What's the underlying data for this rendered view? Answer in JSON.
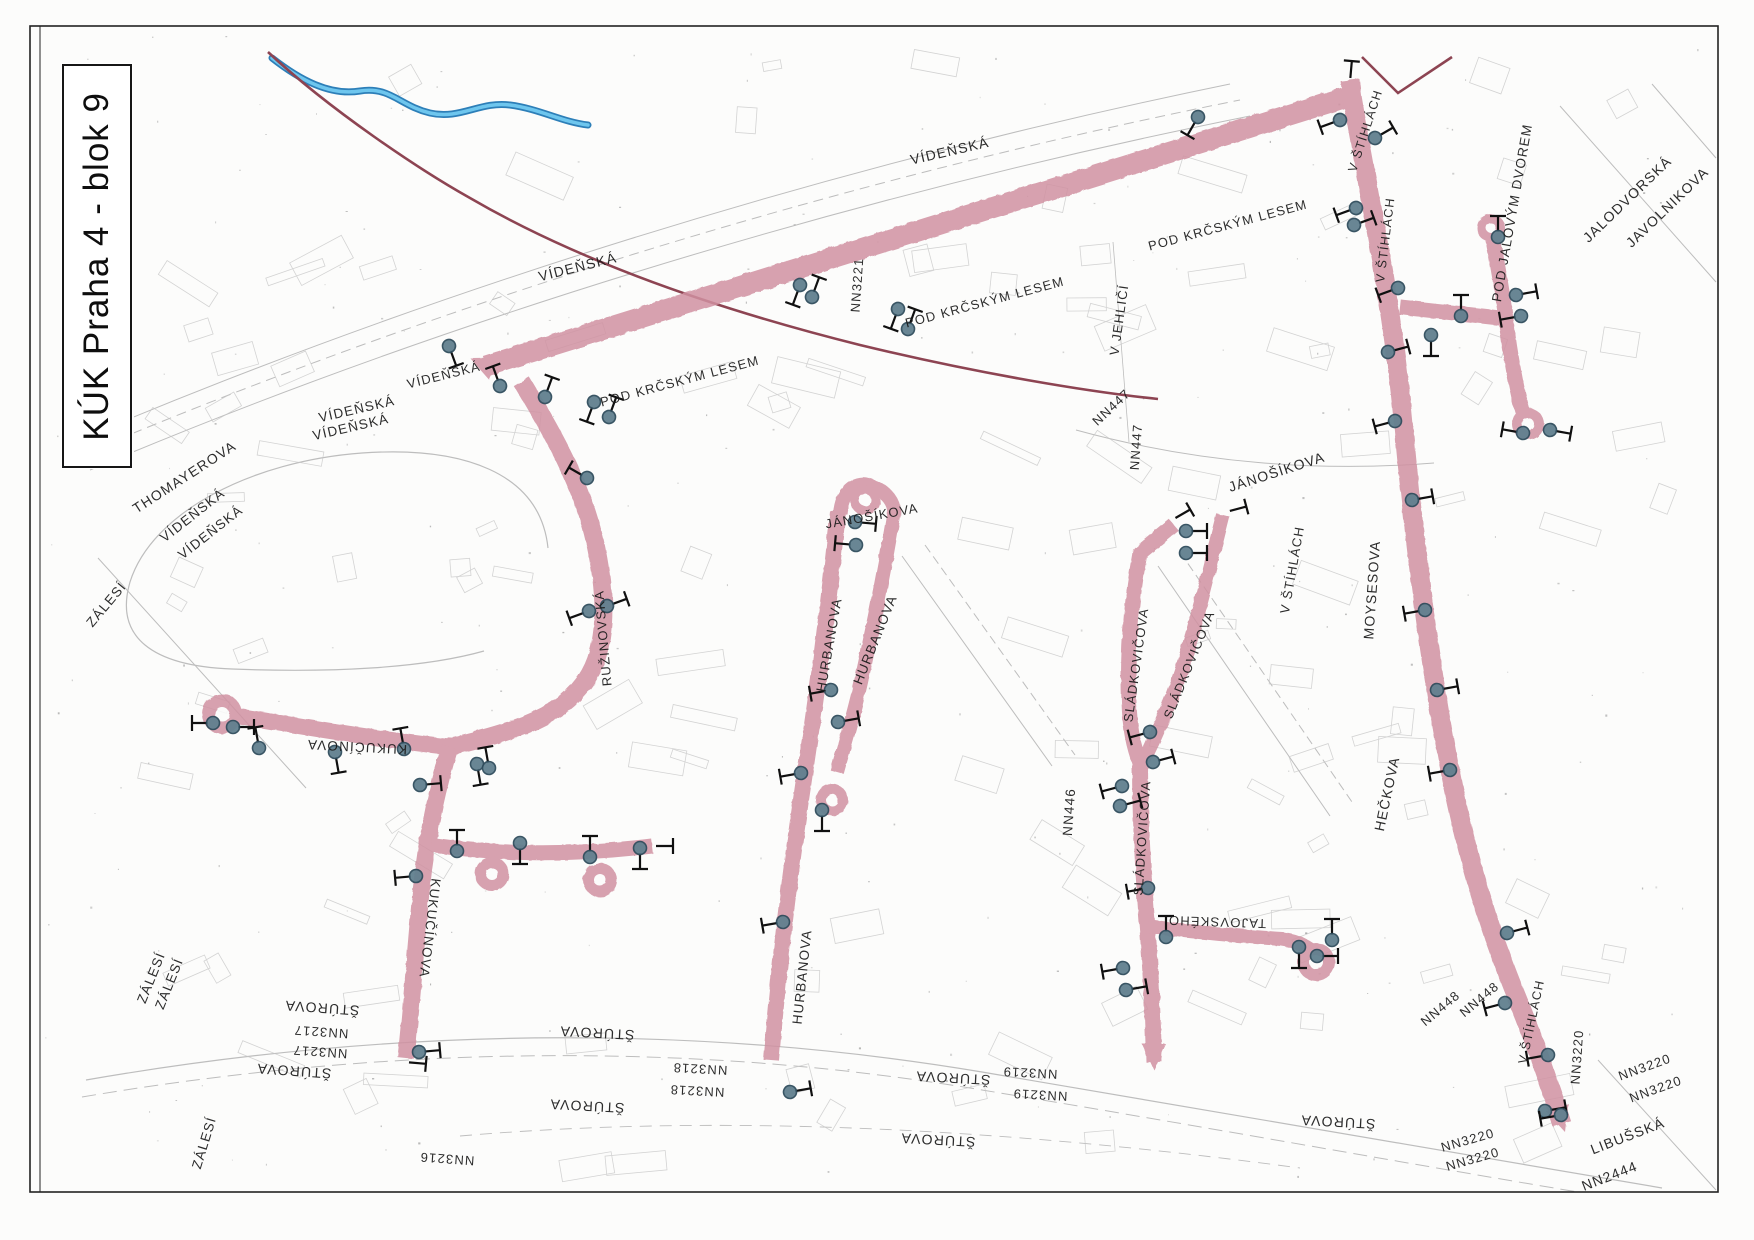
{
  "title": {
    "text": "KÚK Praha 4 - blok 9"
  },
  "map": {
    "colors": {
      "road": "#d191a1",
      "road_hole": "#fcfcfb",
      "boundary": "#8d4452",
      "stream_dark": "#2d7fb8",
      "stream_light": "#6ec6ee",
      "marker_fill": "#61808f",
      "marker_ring": "#2f4c5c",
      "tee": "#101010",
      "label": "#1b1b1b",
      "decor": "#bdbdbd",
      "building": "#c6c6c6",
      "frame": "#222222"
    },
    "frame": {
      "x": 30,
      "y": 26,
      "w": 1688,
      "h": 1166
    },
    "roads": [
      {
        "d": "M 486,366 L 1350,96",
        "w": 21
      },
      {
        "d": "M 1350,80 L 1352,96 C 1366,180 1392,300 1403,420 C 1414,540 1428,655 1449,765 C 1468,866 1492,935 1513,988 C 1532,1034 1550,1085 1562,1124",
        "w": 19
      },
      {
        "d": "M 1400,307 L 1500,318",
        "w": 15
      },
      {
        "d": "M 1493,240 C 1499,272 1503,296 1506,320 C 1510,354 1517,392 1523,413",
        "w": 15
      },
      {
        "d": "M 522,382 C 552,432 582,484 595,542 C 605,588 607,627 596,660 C 584,694 553,716 514,729 C 492,737 466,743 450,747",
        "w": 18
      },
      {
        "d": "M 236,716 C 300,726 380,740 450,747",
        "w": 16
      },
      {
        "d": "M 450,747 C 436,792 426,842 421,892 C 416,942 412,1002 406,1058",
        "w": 17
      },
      {
        "d": "M 431,845 C 490,853 560,857 652,846",
        "w": 15
      },
      {
        "d": "M 838,512 C 833,562 826,622 818,682 C 810,742 800,802 791,872 C 783,932 776,1002 771,1060",
        "w": 16
      },
      {
        "d": "M 840,514 C 842,492 854,481 868,485 C 886,490 897,503 893,519 C 884,572 872,632 861,682 C 852,722 843,750 837,772",
        "w": 14
      },
      {
        "d": "M 1174,525 L 1140,553 C 1131,602 1127,652 1129,702 C 1130,732 1134,747 1140,764",
        "w": 15
      },
      {
        "d": "M 1223,515 C 1211,562 1197,622 1181,672 C 1167,712 1153,742 1143,762",
        "w": 14
      },
      {
        "d": "M 1140,762 C 1140,822 1143,872 1147,922 C 1151,972 1153,1022 1154,1062",
        "w": 16
      },
      {
        "d": "M 1147,926 C 1190,932 1240,936 1282,939 C 1300,941 1312,949 1318,958",
        "w": 14
      }
    ],
    "loops": [
      [
        222,
        714,
        20,
        7
      ],
      [
        492,
        874,
        17,
        6
      ],
      [
        600,
        880,
        17,
        6
      ],
      [
        832,
        800,
        16,
        6
      ],
      [
        865,
        500,
        15,
        6
      ],
      [
        1316,
        962,
        19,
        7
      ],
      [
        1491,
        228,
        14,
        5
      ],
      [
        1528,
        424,
        16,
        6
      ]
    ],
    "arrows": [
      [
        470,
        358,
        -66
      ],
      [
        1154,
        1070,
        180
      ],
      [
        1565,
        1132,
        162
      ]
    ],
    "markers": [
      [
        449,
        346,
        160
      ],
      [
        500,
        386,
        340
      ],
      [
        545,
        397,
        20
      ],
      [
        594,
        402,
        200
      ],
      [
        609,
        417,
        20
      ],
      [
        587,
        478,
        300
      ],
      [
        589,
        611,
        250
      ],
      [
        607,
        606,
        70
      ],
      [
        800,
        285,
        200
      ],
      [
        812,
        297,
        20
      ],
      [
        898,
        309,
        200
      ],
      [
        908,
        329,
        20
      ],
      [
        1198,
        117,
        210
      ],
      [
        1340,
        120,
        250
      ],
      [
        1375,
        138,
        60
      ],
      [
        1356,
        208,
        250
      ],
      [
        1354,
        225,
        70
      ],
      [
        1398,
        288,
        250
      ],
      [
        1388,
        352,
        75
      ],
      [
        1395,
        421,
        255
      ],
      [
        1498,
        237,
        0
      ],
      [
        1516,
        295,
        80
      ],
      [
        1521,
        316,
        260
      ],
      [
        1461,
        316,
        0
      ],
      [
        1431,
        335,
        180
      ],
      [
        1523,
        433,
        280
      ],
      [
        1550,
        430,
        100
      ],
      [
        1412,
        500,
        80
      ],
      [
        1425,
        610,
        260
      ],
      [
        1437,
        690,
        80
      ],
      [
        1450,
        770,
        260
      ],
      [
        1507,
        933,
        75
      ],
      [
        1505,
        1003,
        255
      ],
      [
        1548,
        1055,
        260
      ],
      [
        1545,
        1111,
        80
      ],
      [
        1561,
        1115,
        260
      ],
      [
        213,
        723,
        270
      ],
      [
        233,
        727,
        90
      ],
      [
        259,
        748,
        350
      ],
      [
        335,
        752,
        170
      ],
      [
        404,
        749,
        350
      ],
      [
        477,
        764,
        170
      ],
      [
        489,
        768,
        350
      ],
      [
        420,
        785,
        85
      ],
      [
        416,
        876,
        265
      ],
      [
        419,
        1052,
        85
      ],
      [
        457,
        851,
        0
      ],
      [
        520,
        843,
        180
      ],
      [
        590,
        857,
        0
      ],
      [
        640,
        848,
        180
      ],
      [
        855,
        522,
        95
      ],
      [
        856,
        545,
        275
      ],
      [
        831,
        690,
        260
      ],
      [
        838,
        722,
        80
      ],
      [
        801,
        773,
        260
      ],
      [
        783,
        922,
        260
      ],
      [
        790,
        1092,
        80
      ],
      [
        822,
        810,
        180
      ],
      [
        1186,
        531,
        90
      ],
      [
        1186,
        553,
        90
      ],
      [
        1150,
        732,
        255
      ],
      [
        1153,
        762,
        75
      ],
      [
        1122,
        786,
        255
      ],
      [
        1120,
        806,
        75
      ],
      [
        1148,
        888,
        260
      ],
      [
        1166,
        937,
        0
      ],
      [
        1123,
        968,
        260
      ],
      [
        1126,
        990,
        80
      ],
      [
        1299,
        947,
        180
      ],
      [
        1332,
        940,
        0
      ],
      [
        1317,
        956,
        90
      ]
    ],
    "tees": [
      [
        405,
        1062,
        95
      ],
      [
        652,
        846,
        90
      ],
      [
        1350,
        82,
        5
      ],
      [
        1172,
        520,
        60
      ],
      [
        1226,
        512,
        75
      ]
    ],
    "labels": [
      {
        "t": "VÍDEŇSKÁ",
        "x": 950,
        "y": 152,
        "r": -13,
        "s": 14
      },
      {
        "t": "VÍDEŇSKÁ",
        "x": 578,
        "y": 268,
        "r": -14,
        "s": 14
      },
      {
        "t": "VÍDEŇSKÁ",
        "x": 444,
        "y": 376,
        "r": -14,
        "s": 13
      },
      {
        "t": "VÍDEŇSKÁ",
        "x": 357,
        "y": 410,
        "r": -13,
        "s": 13.5
      },
      {
        "t": "VÍDEŇSKÁ",
        "x": 351,
        "y": 428,
        "r": -13,
        "s": 13.5
      },
      {
        "t": "VÍDEŇSKÁ",
        "x": 193,
        "y": 516,
        "r": -38,
        "s": 13.5
      },
      {
        "t": "VÍDEŇSKÁ",
        "x": 211,
        "y": 533,
        "r": -38,
        "s": 13.5
      },
      {
        "t": "THOMAYEROVA",
        "x": 185,
        "y": 478,
        "r": -33,
        "s": 14
      },
      {
        "t": "ZÁLESÍ",
        "x": 107,
        "y": 605,
        "r": -50,
        "s": 13.5
      },
      {
        "t": "POD KRČSKÝM LESEM",
        "x": 680,
        "y": 382,
        "r": -15,
        "s": 13
      },
      {
        "t": "POD KRČSKÝM LESEM",
        "x": 985,
        "y": 303,
        "r": -15,
        "s": 13
      },
      {
        "t": "POD KRČSKÝM LESEM",
        "x": 1228,
        "y": 226,
        "r": -15,
        "s": 13
      },
      {
        "t": "NN3221",
        "x": 858,
        "y": 285,
        "r": -86,
        "s": 13
      },
      {
        "t": "V JEHLIČÍ",
        "x": 1120,
        "y": 320,
        "r": -82,
        "s": 13
      },
      {
        "t": "NN447",
        "x": 1112,
        "y": 408,
        "r": -43,
        "s": 13
      },
      {
        "t": "NN447",
        "x": 1137,
        "y": 447,
        "r": -86,
        "s": 13
      },
      {
        "t": "JÁNOŠÍKOVA",
        "x": 1277,
        "y": 473,
        "r": -18,
        "s": 14
      },
      {
        "t": "JÁNOŠÍKOVA",
        "x": 872,
        "y": 517,
        "r": -10,
        "s": 13
      },
      {
        "t": "MOYSESOVA",
        "x": 1373,
        "y": 590,
        "r": -86,
        "s": 14
      },
      {
        "t": "V ŠTÍHLÁCH",
        "x": 1293,
        "y": 570,
        "r": -80,
        "s": 13
      },
      {
        "t": "HEČKOVA",
        "x": 1388,
        "y": 794,
        "r": -78,
        "s": 14
      },
      {
        "t": "V ŠTÍHLÁCH",
        "x": 1366,
        "y": 131,
        "r": -72,
        "s": 12.5
      },
      {
        "t": "V ŠTÍHLÁCH",
        "x": 1386,
        "y": 240,
        "r": -83,
        "s": 12.5
      },
      {
        "t": "POD JALOVÝM DVOREM",
        "x": 1513,
        "y": 213,
        "r": -80,
        "s": 13.5
      },
      {
        "t": "JALODVORSKÁ",
        "x": 1628,
        "y": 200,
        "r": -44,
        "s": 14
      },
      {
        "t": "JAVOLNIKOVA",
        "x": 1668,
        "y": 208,
        "r": -44,
        "s": 14
      },
      {
        "t": "RUŽINOVSKÁ",
        "x": 604,
        "y": 638,
        "r": -95,
        "s": 13
      },
      {
        "t": "KUKUČÍNOVA",
        "x": 357,
        "y": 746,
        "r": 183,
        "s": 13.5
      },
      {
        "t": "KUKUČÍNOVA",
        "x": 429,
        "y": 928,
        "r": 97,
        "s": 13.5
      },
      {
        "t": "HURBANOVA",
        "x": 830,
        "y": 645,
        "r": -80,
        "s": 13.5
      },
      {
        "t": "HURBANOVA",
        "x": 876,
        "y": 640,
        "r": -68,
        "s": 13.5
      },
      {
        "t": "HURBANOVA",
        "x": 803,
        "y": 977,
        "r": -84,
        "s": 13.5
      },
      {
        "t": "SLÁDKOVIČOVA",
        "x": 1137,
        "y": 665,
        "r": -82,
        "s": 13
      },
      {
        "t": "SLÁDKOVIČOVA",
        "x": 1190,
        "y": 665,
        "r": -68,
        "s": 13
      },
      {
        "t": "SLÁDKOVIČOVA",
        "x": 1143,
        "y": 838,
        "r": -86,
        "s": 13
      },
      {
        "t": "TAJOVSKÉHO",
        "x": 1217,
        "y": 921,
        "r": 182,
        "s": 13
      },
      {
        "t": "NN446",
        "x": 1070,
        "y": 812,
        "r": -86,
        "s": 13.5
      },
      {
        "t": "NN448",
        "x": 1441,
        "y": 1009,
        "r": -40,
        "s": 13
      },
      {
        "t": "NN448",
        "x": 1480,
        "y": 1000,
        "r": -40,
        "s": 13
      },
      {
        "t": "V ŠTÍHLÁCH",
        "x": 1532,
        "y": 1022,
        "r": -78,
        "s": 12.5
      },
      {
        "t": "NN3220",
        "x": 1578,
        "y": 1057,
        "r": -86,
        "s": 13
      },
      {
        "t": "NN3220",
        "x": 1645,
        "y": 1068,
        "r": -20,
        "s": 13
      },
      {
        "t": "NN3220",
        "x": 1656,
        "y": 1090,
        "r": -20,
        "s": 13
      },
      {
        "t": "ŠTÚROVA",
        "x": 1338,
        "y": 1121,
        "r": 183,
        "s": 14
      },
      {
        "t": "NN3220",
        "x": 1468,
        "y": 1141,
        "r": -16,
        "s": 13
      },
      {
        "t": "NN3220",
        "x": 1473,
        "y": 1160,
        "r": -16,
        "s": 13
      },
      {
        "t": "LIBUŠSKÁ",
        "x": 1628,
        "y": 1137,
        "r": -21,
        "s": 14
      },
      {
        "t": "NN2444",
        "x": 1610,
        "y": 1177,
        "r": -21,
        "s": 14
      },
      {
        "t": "ŠTÚROVA",
        "x": 322,
        "y": 1007,
        "r": 184,
        "s": 14
      },
      {
        "t": "NN3217",
        "x": 321,
        "y": 1031,
        "r": 184,
        "s": 13
      },
      {
        "t": "NN3217",
        "x": 320,
        "y": 1051,
        "r": 184,
        "s": 13
      },
      {
        "t": "ŠTÚROVA",
        "x": 294,
        "y": 1070,
        "r": 184,
        "s": 14
      },
      {
        "t": "ZÁLESÍ",
        "x": 152,
        "y": 978,
        "r": -68,
        "s": 13.5
      },
      {
        "t": "ZÁLESÍ",
        "x": 170,
        "y": 984,
        "r": -68,
        "s": 13.5
      },
      {
        "t": "ZÁLESÍ",
        "x": 205,
        "y": 1143,
        "r": -73,
        "s": 13.5
      },
      {
        "t": "NN3216",
        "x": 447,
        "y": 1158,
        "r": 184,
        "s": 13
      },
      {
        "t": "ŠTÚROVA",
        "x": 597,
        "y": 1032,
        "r": 183,
        "s": 14
      },
      {
        "t": "NN3218",
        "x": 700,
        "y": 1068,
        "r": 183,
        "s": 13
      },
      {
        "t": "NN3218",
        "x": 697,
        "y": 1090,
        "r": 183,
        "s": 13
      },
      {
        "t": "ŠTÚROVA",
        "x": 587,
        "y": 1105,
        "r": 183,
        "s": 14
      },
      {
        "t": "ŠTÚROVA",
        "x": 953,
        "y": 1077,
        "r": 183,
        "s": 14
      },
      {
        "t": "ŠTÚROVA",
        "x": 938,
        "y": 1139,
        "r": 183,
        "s": 14
      },
      {
        "t": "NN3219",
        "x": 1030,
        "y": 1072,
        "r": 183,
        "s": 13
      },
      {
        "t": "NN3219",
        "x": 1040,
        "y": 1094,
        "r": 183,
        "s": 13
      }
    ],
    "stream": "M 272,58 C 300,80 330,96 360,91 C 390,86 400,106 430,113 C 460,120 480,101 510,105 C 540,109 562,122 588,125",
    "boundary": [
      "M 268,52 C 330,110 420,170 470,198 C 580,262 720,310 860,345 C 980,374 1090,392 1158,399",
      "M 1362,57 L 1398,93 L 1452,57"
    ],
    "decor_lines": [
      {
        "d": "M 88,436 C 420,296 820,168 1230,84",
        "w": 1
      },
      {
        "d": "M 88,452 C 420,312 820,184 1240,100",
        "w": 1,
        "da": "10 6"
      },
      {
        "d": "M 90,470 C 420,330 830,200 1250,116",
        "w": 1
      },
      {
        "d": "M 548,548 C 540,472 462,446 362,453 C 252,461 152,512 130,582 C 114,637 152,666 232,669 C 332,673 424,668 484,651",
        "w": 1.2
      },
      {
        "d": "M 86,1080 C 420,1022 720,1028 982,1072 C 1202,1108 1430,1150 1662,1188",
        "w": 1.2
      },
      {
        "d": "M 82,1097 C 420,1040 720,1046 982,1090 C 1202,1126 1430,1168 1656,1205",
        "w": 1,
        "da": "14 7"
      },
      {
        "d": "M 98,558 L 306,788",
        "w": 1
      },
      {
        "d": "M 1076,430 C 1200,464 1322,472 1434,463",
        "w": 1
      },
      {
        "d": "M 1560,106 L 1716,282",
        "w": 1
      },
      {
        "d": "M 1652,84 L 1716,158",
        "w": 1
      },
      {
        "d": "M 1598,1060 L 1716,1190",
        "w": 1
      },
      {
        "d": "M 1113,242 L 1129,442",
        "w": 0.8
      },
      {
        "d": "M 1158,566 L 1330,816",
        "w": 1
      },
      {
        "d": "M 1180,552 L 1352,802",
        "w": 1,
        "da": "9 5"
      },
      {
        "d": "M 902,556 L 1052,766",
        "w": 1
      },
      {
        "d": "M 925,545 L 1075,755",
        "w": 1,
        "da": "9 5"
      },
      {
        "d": "M 460,1136 C 760,1110 1060,1136 1300,1168",
        "w": 0.9,
        "da": "12 8"
      }
    ]
  }
}
